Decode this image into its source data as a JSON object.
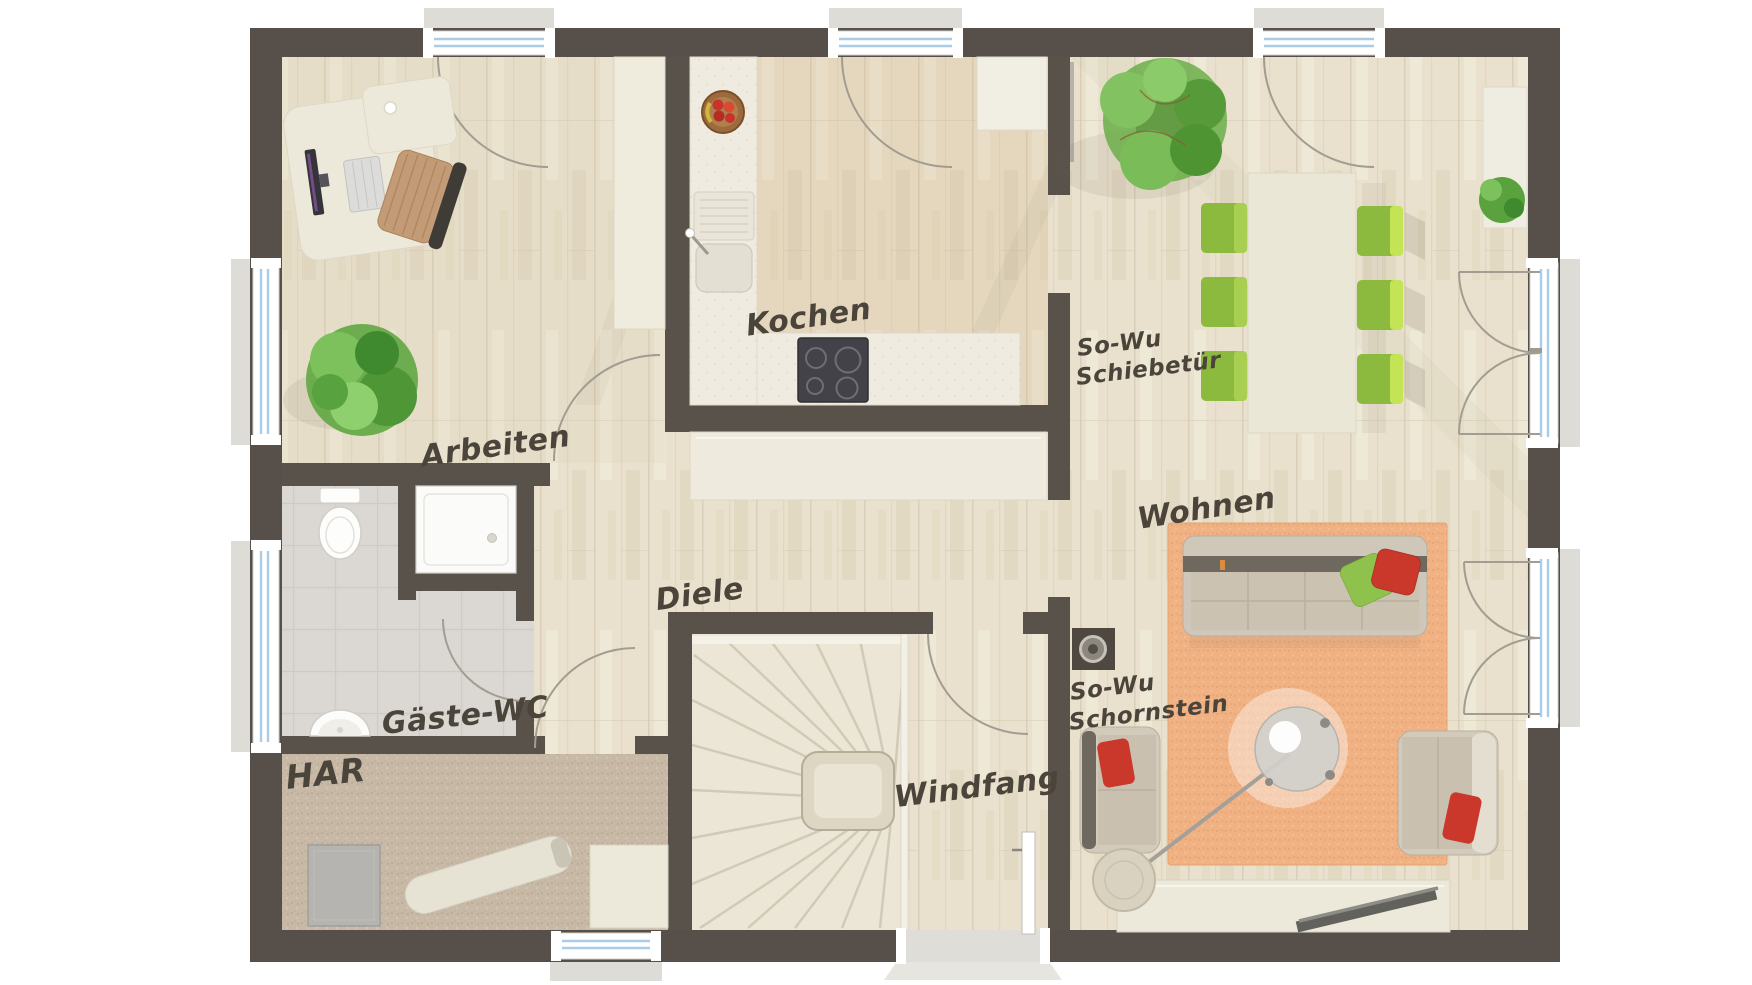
{
  "floor_plan": {
    "rooms": [
      {
        "id": "arbeiten",
        "label": "Arbeiten"
      },
      {
        "id": "kochen",
        "label": "Kochen"
      },
      {
        "id": "diele",
        "label": "Diele"
      },
      {
        "id": "gaeste_wc",
        "label": "Gäste-WC"
      },
      {
        "id": "har",
        "label": "HAR"
      },
      {
        "id": "windfang",
        "label": "Windfang"
      },
      {
        "id": "wohnen",
        "label": "Wohnen"
      }
    ],
    "annotations": [
      {
        "id": "schiebetuer",
        "line1": "So-Wu",
        "line2": "Schiebetür"
      },
      {
        "id": "schornstein",
        "line1": "So-Wu",
        "line2": "Schornstein"
      }
    ],
    "colors": {
      "wall": "#57504a",
      "wood_floor": "#e9e1cd",
      "kitchen_counter": "#efebe0",
      "tile_floor": "#d9d6d1",
      "carpet_floor": "#c7b9a6",
      "rug_orange": "#f0b183",
      "chair_green": "#8cba3e",
      "chair_green_light": "#c3e455",
      "pillow_red": "#c9382b",
      "pillow_green": "#8fc24c",
      "glazing_blue": "#a9cde9",
      "label_ink": "#4b443b",
      "furniture_cream": "#ece8da",
      "sofa_beige": "#cfc8ba"
    }
  }
}
